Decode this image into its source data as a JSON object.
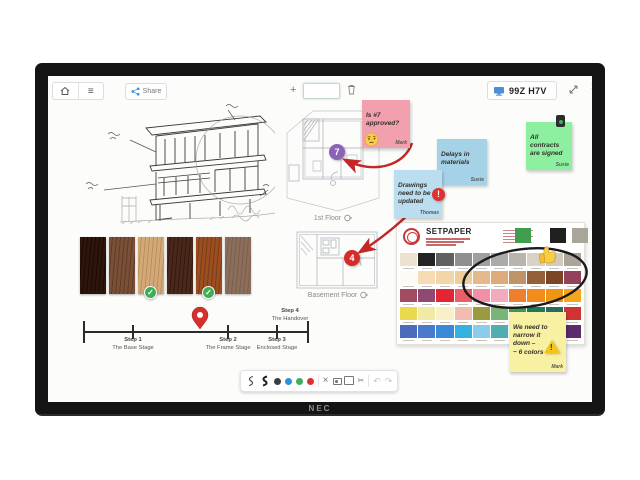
{
  "device": {
    "brand": "NEC"
  },
  "icons": {
    "menu": "≡",
    "plus": "+",
    "close": "×",
    "clear": "×",
    "scissors": "✂",
    "undo": "↶",
    "redo": "↷",
    "check": "✓",
    "excl": "!"
  },
  "topbar": {
    "share_label": "Share",
    "session_code": "99Z H7V"
  },
  "canvas": {
    "plans": {
      "first_floor": {
        "label": "1st Floor",
        "marker": "7"
      },
      "basement": {
        "label": "Basement Floor",
        "marker": "4"
      }
    },
    "timeline": {
      "steps": [
        {
          "step": "Step 1",
          "name": "The Base Stage"
        },
        {
          "step": "Step 2",
          "name": "The Frame Stage"
        },
        {
          "step": "Step 3",
          "name": "Enclosed Stage"
        },
        {
          "step": "Step 4",
          "name": "The Handover"
        }
      ]
    },
    "notes": [
      {
        "text": "Is #7\napproved?",
        "author": "Mark",
        "color": "#f29fae"
      },
      {
        "text": "Delays in\nmaterials",
        "author": "Susie",
        "color": "#a6d2e8"
      },
      {
        "text": "Drawings\nneed to be\nupdated",
        "author": "Thomas",
        "color": "#badeef"
      },
      {
        "text": "All\ncontracts\nare signed",
        "author": "Susie",
        "color": "#8df0a1"
      },
      {
        "text": "We need to\nnarrow it\ndown –\n~ 6 colors",
        "author": "Mark",
        "color": "#f8f0a2"
      }
    ],
    "palette_card": {
      "brand": "SETPAPER",
      "header_swatches": [
        "#3e9e4e",
        "#202020",
        "#a9a59b"
      ],
      "rows": [
        [
          "#ece2cf",
          "#232323",
          "#606060",
          "#8f8f8f",
          "#9f9f9f",
          "#ababab",
          "#b9b5ad",
          "#d9d2c6",
          "#d2cabc",
          "#aaa49a"
        ],
        [
          "#fdfbf5",
          "#f6dcb2",
          "#f3d6a8",
          "#efce9c",
          "#e5ba8a",
          "#dcab79",
          "#be9468",
          "#94603a",
          "#7c4526",
          "#93425c"
        ],
        [
          "#a34b60",
          "#8f4a72",
          "#e32535",
          "#ea5f66",
          "#f18fa8",
          "#f2abbe",
          "#ee7f2e",
          "#f28c1c",
          "#f09414",
          "#f2a71e"
        ],
        [
          "#e9d94f",
          "#f2e9a6",
          "#f8f0c8",
          "#f2bdb0",
          "#9a9a40",
          "#79b579",
          "#3c9b52",
          "#1f7a55",
          "#2a6a62",
          "#cf3434"
        ],
        [
          "#4a6cba",
          "#4a7acb",
          "#3b89d9",
          "#33b2e2",
          "#8ccbe9",
          "#52aeae",
          "#2b9a9a",
          "#217a8a",
          "#4a3b79",
          "#5c2b6b"
        ]
      ]
    },
    "wood_swatches": [
      {
        "base": "#2e150b",
        "grain": "#1c0b05",
        "approved": false
      },
      {
        "base": "#7a5037",
        "grain": "#5f3c28",
        "approved": false
      },
      {
        "base": "#d2a977",
        "grain": "#ba8e5d",
        "approved": true
      },
      {
        "base": "#49291b",
        "grain": "#35180d",
        "approved": false
      },
      {
        "base": "#9b4e21",
        "grain": "#7e3c15",
        "approved": true
      },
      {
        "base": "#8c6e5b",
        "grain": "#79604f",
        "approved": false
      }
    ]
  },
  "bottom_toolbar": {
    "pen_colors": [
      "#3d3d3d",
      "#2d8fe0",
      "#3fae5f",
      "#df3030"
    ]
  },
  "accents": {
    "annotation_red": "#c42727",
    "share_blue": "#3a8fe0"
  }
}
